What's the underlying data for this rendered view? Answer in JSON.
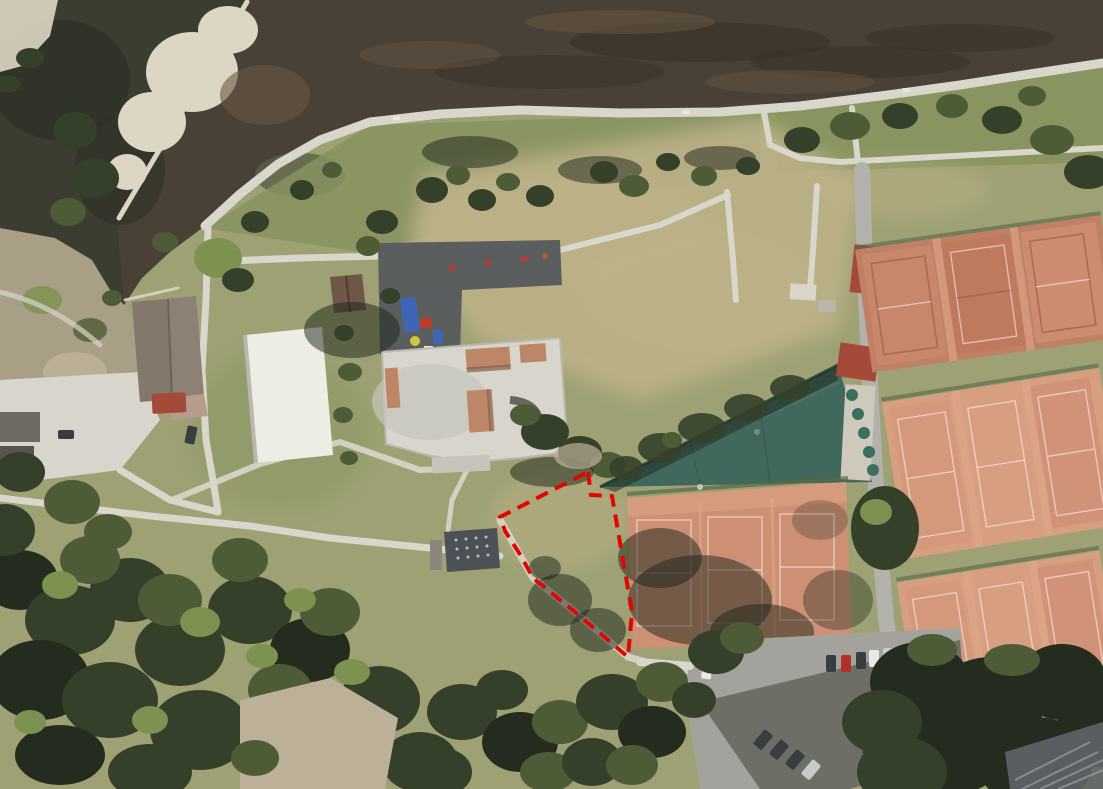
{
  "canvas": {
    "width": 1103,
    "height": 789
  },
  "scene": {
    "type": "aerial-satellite-photo",
    "description": "Aerial view of a riverside park: river with gravel bed and weir at top, riverside footpath, park lawn with playground and concrete skatepark, white flat-roof building, gable-roof houses, long teal wedge-roof clubhouse, multiple clay tennis court blocks, parking lot with cars, dense tree canopies, and a red dashed boundary marking a triangular plot of land",
    "features": [
      "river",
      "weir",
      "gravel-bank",
      "riverside-path",
      "park-paths",
      "playground",
      "skatepark",
      "white-building",
      "gable-roof-house",
      "clubhouse-teal-wedge-roof",
      "clay-tennis-courts",
      "parking-lot",
      "tree-canopy",
      "plot-boundary-annotation"
    ]
  },
  "annotation": {
    "label": "plot-boundary",
    "shape": "polygon",
    "points": "588,472 591,495 612,496 632,612 628,657 575,612 533,578 521,556 505,531 500,517",
    "stroke_color": "#e10600",
    "line_style": "dashed"
  },
  "colors": {
    "water_deep": "#2e3126",
    "water": "#3a3d30",
    "riverbed": "#4a4136",
    "riverbed_dark": "#382f26",
    "riverbed_light": "#675744",
    "gravel": "#ded6c4",
    "bank_scrub": "#a89f86",
    "dirt": "#bdb098",
    "path": "#d9d6cb",
    "grass_base": "#9da173",
    "grass_green": "#87935f",
    "grass_dry": "#bfb289",
    "tree_dark": "#35402b",
    "tree_mid": "#4d5c37",
    "tree_light": "#7d9150",
    "tree_deepest": "#242c1f",
    "shadow": "rgba(28,36,26,0.5)",
    "concrete": "#d7d5cc",
    "concrete_dim": "#c6c4bb",
    "ramp": "#bd8666",
    "ramp_shadow": "#8a5a44",
    "asphalt": "#5b5e5f",
    "pad": "#4b5157",
    "play_blue": "#3f66b5",
    "play_red": "#c03a2c",
    "play_yellow": "#d2c63e",
    "roof_white": "#edece5",
    "roof_gray_brown": "#8d8175",
    "roof_gray_brown2": "#84786d",
    "roof_brown": "#6f5748",
    "roof_red": "#a54a39",
    "roof_annex": "#b59c8b",
    "roof_teal": "#40685d",
    "roof_teal_dark": "#2d4b42",
    "roof_teal_light": "#527d6f",
    "clay_dark": "#c08065",
    "clay_mid": "#cd9074",
    "clay_light": "#d89e80",
    "clay_gap": "#dfa98b",
    "court_line": "rgba(255,255,255,0.5)",
    "court_line_dark": "#9c5f45",
    "fence_green": "#55684a",
    "road": "#b3b1ab",
    "parking": "#a3a29c",
    "car_white": "#e9e9e6",
    "car_red": "#b23026",
    "car_dark": "#383d40",
    "car_silver": "#c7cac7",
    "car_darkred": "#7e2a22",
    "ribbed": "#5f6567",
    "rib_line": "#9aa0a2",
    "annotation_red": "#e10600"
  }
}
